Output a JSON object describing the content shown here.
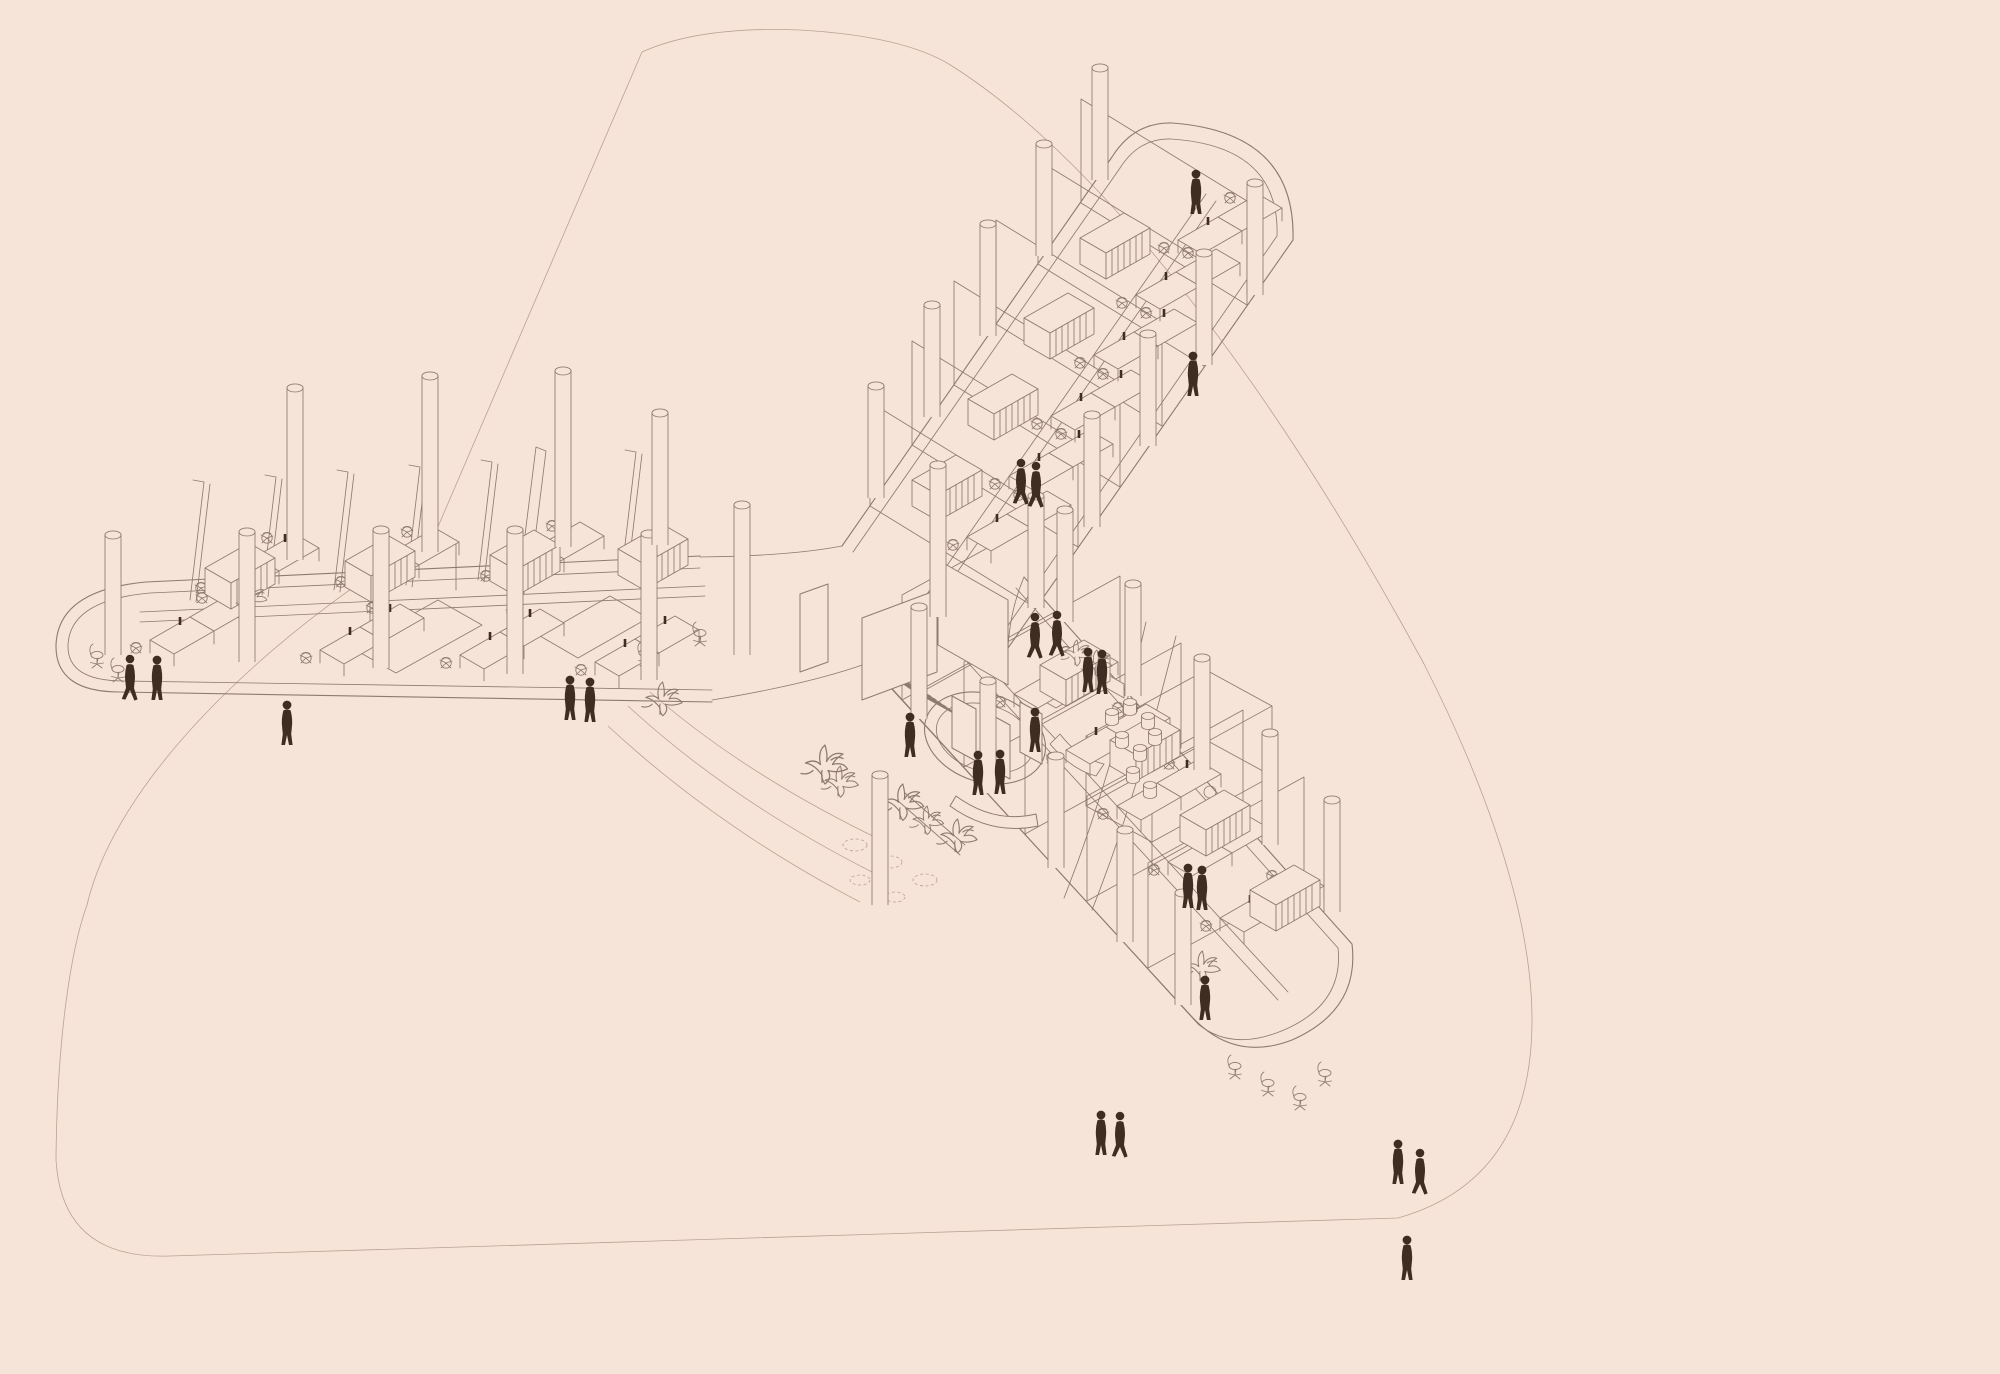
{
  "meta": {
    "description": "Axonometric wireframe drawing of a Y-shaped open-plan office floor, pale pink background, dark figure silhouettes",
    "drawing_type": "architectural axonometric line illustration"
  },
  "colors": {
    "background": "#f7e4d8",
    "line": "#8d7b6f",
    "lineLight": "#b8a294",
    "figure": "#3f2d24"
  },
  "scene": {
    "people": [
      {
        "x": 130,
        "y": 700,
        "v": "sym-person-walk"
      },
      {
        "x": 157,
        "y": 700,
        "v": "sym-person-stand"
      },
      {
        "x": 287,
        "y": 745,
        "v": "sym-person-stand"
      },
      {
        "x": 570,
        "y": 720,
        "v": "sym-person-stand"
      },
      {
        "x": 590,
        "y": 722,
        "v": "sym-person-stand"
      },
      {
        "x": 910,
        "y": 757,
        "v": "sym-person-stand"
      },
      {
        "x": 1035,
        "y": 752,
        "v": "sym-person-stand"
      },
      {
        "x": 978,
        "y": 795,
        "v": "sym-person-stand"
      },
      {
        "x": 1000,
        "y": 794,
        "v": "sym-person-stand"
      },
      {
        "x": 1035,
        "y": 658,
        "v": "sym-person-walk"
      },
      {
        "x": 1057,
        "y": 656,
        "v": "sym-person-walk"
      },
      {
        "x": 1088,
        "y": 692,
        "v": "sym-person-stand"
      },
      {
        "x": 1102,
        "y": 694,
        "v": "sym-person-stand"
      },
      {
        "x": 1021,
        "y": 504,
        "v": "sym-person-walk"
      },
      {
        "x": 1036,
        "y": 507,
        "v": "sym-person-walk"
      },
      {
        "x": 1196,
        "y": 214,
        "v": "sym-person-stand"
      },
      {
        "x": 1193,
        "y": 396,
        "v": "sym-person-stand"
      },
      {
        "x": 1188,
        "y": 908,
        "v": "sym-person-stand"
      },
      {
        "x": 1202,
        "y": 910,
        "v": "sym-person-stand"
      },
      {
        "x": 1205,
        "y": 1020,
        "v": "sym-person-stand"
      },
      {
        "x": 1101,
        "y": 1155,
        "v": "sym-person-stand"
      },
      {
        "x": 1120,
        "y": 1157,
        "v": "sym-person-walk"
      },
      {
        "x": 1398,
        "y": 1184,
        "v": "sym-person-stand"
      },
      {
        "x": 1420,
        "y": 1194,
        "v": "sym-person-walk"
      },
      {
        "x": 1407,
        "y": 1280,
        "v": "sym-person-stand"
      }
    ],
    "columns": [
      {
        "x": 113,
        "y": 655,
        "h": 120
      },
      {
        "x": 247,
        "y": 662,
        "h": 130
      },
      {
        "x": 381,
        "y": 668,
        "h": 138
      },
      {
        "x": 515,
        "y": 674,
        "h": 144
      },
      {
        "x": 649,
        "y": 680,
        "h": 146
      },
      {
        "x": 295,
        "y": 560,
        "h": 172
      },
      {
        "x": 430,
        "y": 552,
        "h": 176
      },
      {
        "x": 563,
        "y": 547,
        "h": 176
      },
      {
        "x": 660,
        "y": 545,
        "h": 132
      },
      {
        "x": 742,
        "y": 655,
        "h": 150
      },
      {
        "x": 938,
        "y": 617,
        "h": 152
      },
      {
        "x": 880,
        "y": 905,
        "h": 130
      },
      {
        "x": 876,
        "y": 498,
        "h": 112
      },
      {
        "x": 932,
        "y": 417,
        "h": 112
      },
      {
        "x": 988,
        "y": 336,
        "h": 112
      },
      {
        "x": 1044,
        "y": 256,
        "h": 112
      },
      {
        "x": 1100,
        "y": 180,
        "h": 112
      },
      {
        "x": 1036,
        "y": 608,
        "h": 112
      },
      {
        "x": 1092,
        "y": 527,
        "h": 112
      },
      {
        "x": 1148,
        "y": 446,
        "h": 112
      },
      {
        "x": 1204,
        "y": 365,
        "h": 112
      },
      {
        "x": 1255,
        "y": 295,
        "h": 112
      },
      {
        "x": 919,
        "y": 719,
        "h": 112
      },
      {
        "x": 988,
        "y": 793,
        "h": 112
      },
      {
        "x": 1056,
        "y": 868,
        "h": 112
      },
      {
        "x": 1125,
        "y": 942,
        "h": 112
      },
      {
        "x": 1183,
        "y": 1005,
        "h": 112
      },
      {
        "x": 1065,
        "y": 622,
        "h": 112
      },
      {
        "x": 1133,
        "y": 696,
        "h": 112
      },
      {
        "x": 1202,
        "y": 770,
        "h": 112
      },
      {
        "x": 1270,
        "y": 845,
        "h": 112
      },
      {
        "x": 1332,
        "y": 912,
        "h": 112
      }
    ],
    "desks": [
      {
        "x": 150,
        "y": 640
      },
      {
        "x": 320,
        "y": 650
      },
      {
        "x": 460,
        "y": 655
      },
      {
        "x": 595,
        "y": 662
      },
      {
        "x": 215,
        "y": 580
      },
      {
        "x": 355,
        "y": 574
      },
      {
        "x": 500,
        "y": 568
      },
      {
        "x": 967,
        "y": 537
      },
      {
        "x": 1009,
        "y": 476
      },
      {
        "x": 1051,
        "y": 416
      },
      {
        "x": 1094,
        "y": 355
      },
      {
        "x": 1136,
        "y": 295
      },
      {
        "x": 1178,
        "y": 240
      },
      {
        "x": 1014,
        "y": 694
      },
      {
        "x": 1066,
        "y": 750
      },
      {
        "x": 1117,
        "y": 806
      },
      {
        "x": 1168,
        "y": 862
      },
      {
        "x": 1220,
        "y": 918
      }
    ],
    "shelves": [
      {
        "x": 205,
        "y": 568
      },
      {
        "x": 345,
        "y": 561
      },
      {
        "x": 490,
        "y": 555
      },
      {
        "x": 618,
        "y": 549
      },
      {
        "x": 912,
        "y": 480
      },
      {
        "x": 968,
        "y": 399
      },
      {
        "x": 1024,
        "y": 318
      },
      {
        "x": 1080,
        "y": 238
      },
      {
        "x": 1040,
        "y": 665
      },
      {
        "x": 1110,
        "y": 740
      },
      {
        "x": 1180,
        "y": 815
      },
      {
        "x": 1250,
        "y": 890
      }
    ],
    "stools": [
      {
        "x": 1112,
        "y": 722
      },
      {
        "x": 1130,
        "y": 712
      },
      {
        "x": 1148,
        "y": 726
      },
      {
        "x": 1122,
        "y": 745
      },
      {
        "x": 1140,
        "y": 758
      },
      {
        "x": 1155,
        "y": 742
      },
      {
        "x": 1133,
        "y": 780
      },
      {
        "x": 1150,
        "y": 795
      }
    ],
    "plants": [
      {
        "x": 1075,
        "y": 660,
        "s": 1
      },
      {
        "x": 1095,
        "y": 670,
        "s": 1
      },
      {
        "x": 822,
        "y": 775,
        "s": 1.5
      },
      {
        "x": 838,
        "y": 790,
        "s": 1.2
      },
      {
        "x": 900,
        "y": 812,
        "s": 1.4
      },
      {
        "x": 925,
        "y": 828,
        "s": 1.1
      },
      {
        "x": 955,
        "y": 845,
        "s": 1.3
      },
      {
        "x": 1200,
        "y": 975,
        "s": 1.2
      },
      {
        "x": 660,
        "y": 708,
        "s": 1.3
      },
      {
        "x": 250,
        "y": 604,
        "s": 1
      }
    ],
    "chairs": [
      {
        "x": 1235,
        "y": 1075
      },
      {
        "x": 1268,
        "y": 1092
      },
      {
        "x": 1300,
        "y": 1106
      },
      {
        "x": 1325,
        "y": 1082
      },
      {
        "x": 700,
        "y": 642
      },
      {
        "x": 645,
        "y": 662
      },
      {
        "x": 97,
        "y": 664
      },
      {
        "x": 118,
        "y": 678
      }
    ]
  }
}
